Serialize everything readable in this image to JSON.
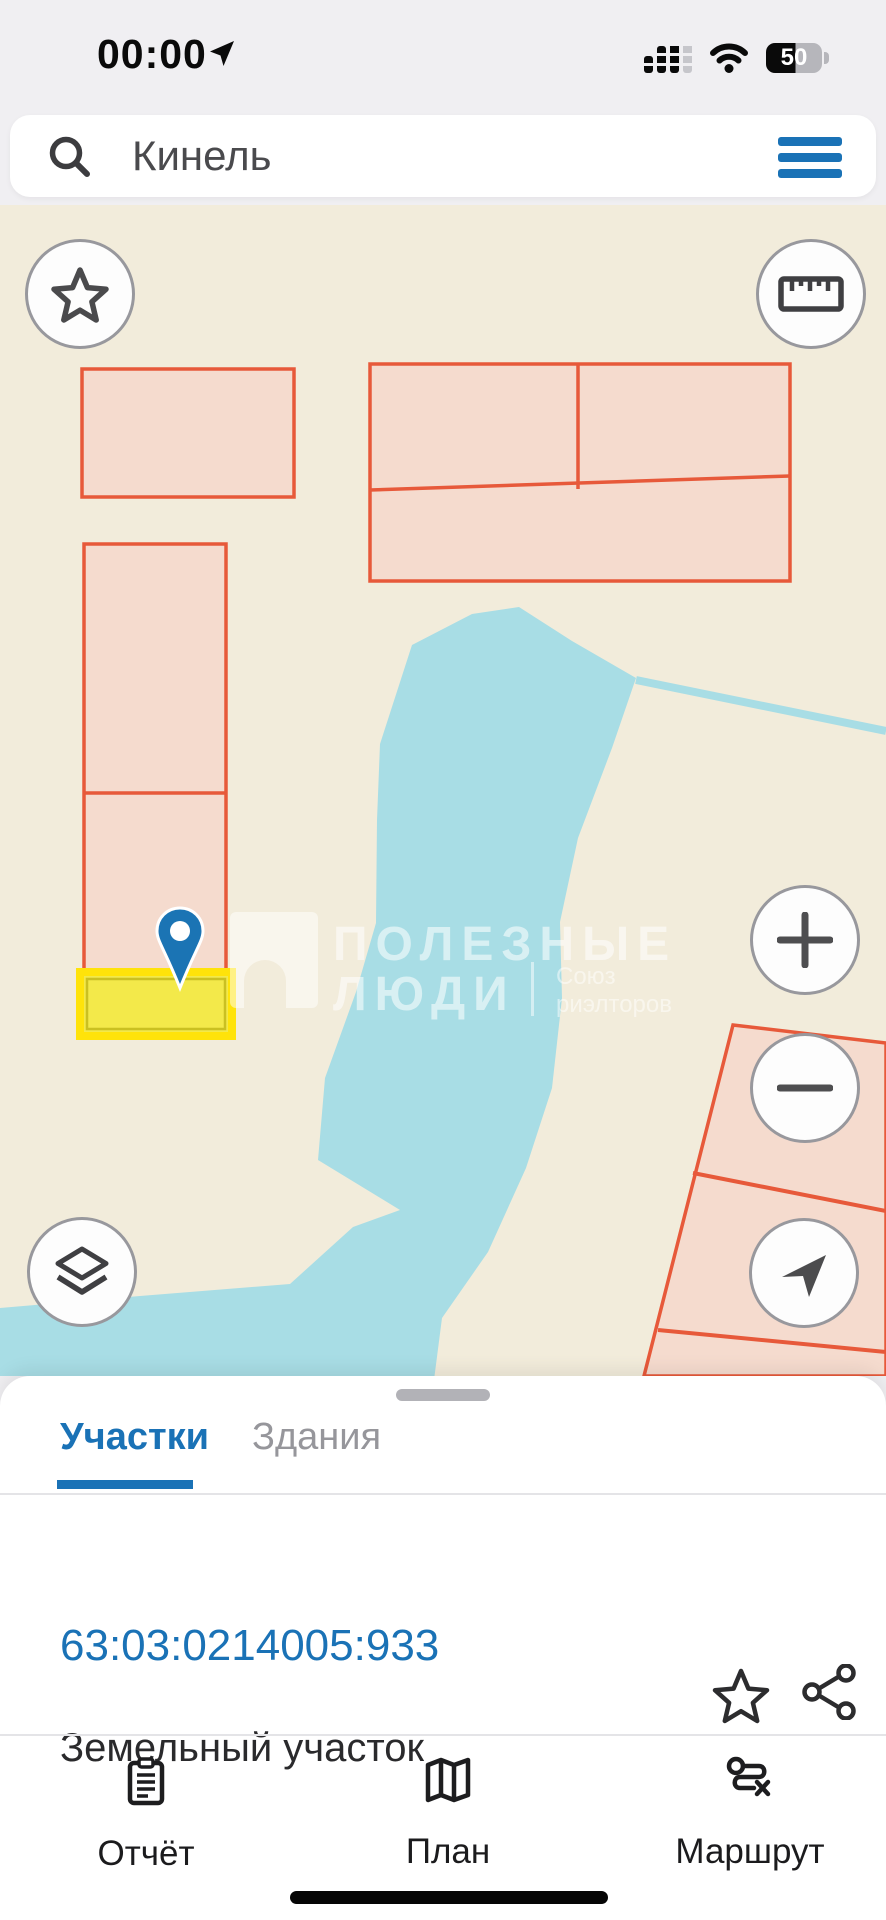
{
  "status_bar": {
    "time": "00:00",
    "battery_percent": "50"
  },
  "search": {
    "query": "Кинель"
  },
  "map": {
    "background_color": "#f2ecdb",
    "water_color": "#a8dde5",
    "parcel_fill": "#f5dbce",
    "parcel_border": "#e7593a",
    "selected_parcel_fill": "#f3e94a",
    "selected_parcel_border": "#ffe30a",
    "pin_color": "#1b74b4",
    "watermark": {
      "brand_line1": "ПОЛЕЗНЫЕ",
      "brand_line2": "ЛЮДИ",
      "org_line1": "Союз",
      "org_line2": "риэлторов"
    },
    "controls": [
      "favorites-star",
      "ruler",
      "zoom-in",
      "zoom-out",
      "layers",
      "my-location"
    ]
  },
  "sheet": {
    "accent_color": "#1a72b6",
    "tabs": [
      {
        "label": "Участки",
        "active": true
      },
      {
        "label": "Здания",
        "active": false
      }
    ],
    "parcel": {
      "id": "63:03:0214005:933",
      "type": "Земельный участок"
    }
  },
  "bottom_nav": {
    "items": [
      {
        "label": "Отчёт"
      },
      {
        "label": "План"
      },
      {
        "label": "Маршрут"
      }
    ]
  }
}
